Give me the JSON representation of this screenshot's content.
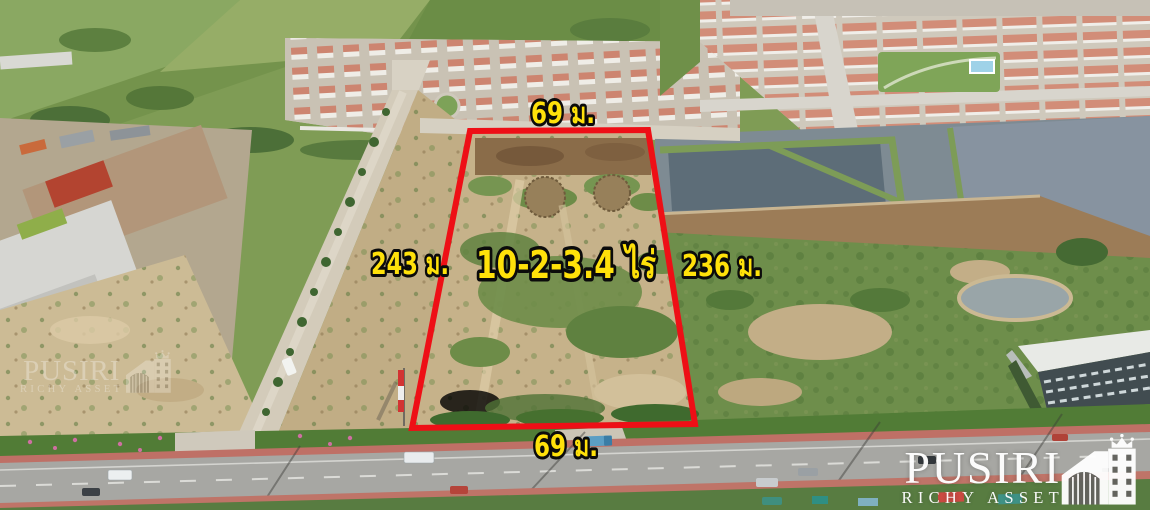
{
  "plot": {
    "area_label": "10-2-3.4 ไร่",
    "top_width_label": "69 ม.",
    "bottom_width_label": "69 ม.",
    "left_depth_label": "243 ม.",
    "right_depth_label": "236 ม."
  },
  "branding": {
    "logo_name": "PUSIRI",
    "logo_subtitle": "RICHY ASSET",
    "watermark_name": "PUSIRI",
    "watermark_subtitle": "RICHY ASSET"
  },
  "colors": {
    "boundary_red": "#ee0f16",
    "label_yellow": "#ffe10a",
    "label_outline": "#0b0b0b",
    "logo_white": "#ffffff"
  }
}
